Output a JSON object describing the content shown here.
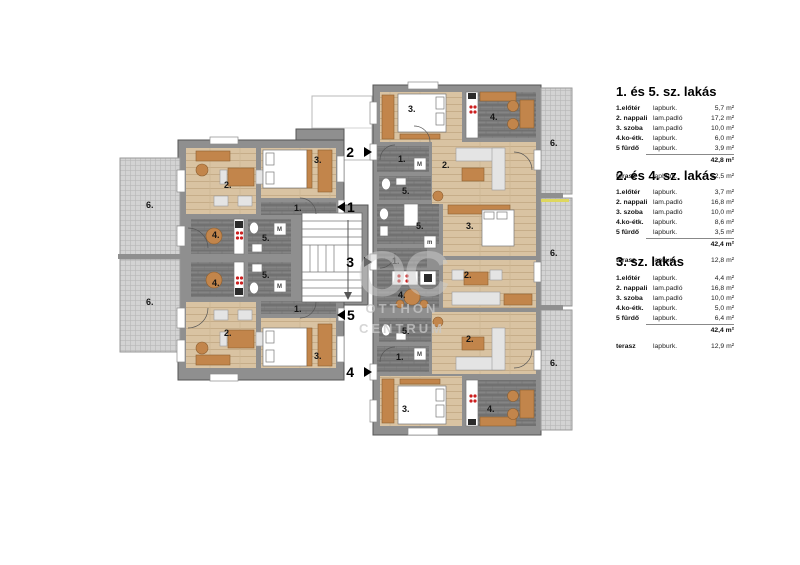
{
  "plan": {
    "room_labels": {
      "entry": "1.",
      "living": "2.",
      "bedroom": "3.",
      "kitchen": "4.",
      "bath": "5.",
      "terrace": "6."
    },
    "entries": [
      "1",
      "2",
      "3",
      "4",
      "5"
    ],
    "fixtures": {
      "washer": "M",
      "washer_small": "m"
    }
  },
  "watermark": {
    "logo": "OC",
    "line1": "OTTHON",
    "line2": "CENTRUM"
  },
  "legend": {
    "sections": [
      {
        "title": "1. és 5. sz. lakás",
        "rows": [
          {
            "name": "1.előtér",
            "finish": "lapburk.",
            "area": "5,7 m²"
          },
          {
            "name": "2. nappali",
            "finish": "lam.padló",
            "area": "17,2 m²"
          },
          {
            "name": "3. szoba",
            "finish": "lam.padló",
            "area": "10,0 m²"
          },
          {
            "name": "4.ko-étk.",
            "finish": "lapburk.",
            "area": "6,0 m²"
          },
          {
            "name": "5 fürdő",
            "finish": "lapburk.",
            "area": "3,9 m²"
          }
        ],
        "total": "42,8 m²",
        "terrace": {
          "name": "terasz",
          "finish": "lapburk.",
          "area": "12,5 m²"
        }
      },
      {
        "title": "2. és 4. sz. lakás",
        "rows": [
          {
            "name": "1.előtér",
            "finish": "lapburk.",
            "area": "3,7 m²"
          },
          {
            "name": "2. nappali",
            "finish": "lam.padló",
            "area": "16,8 m²"
          },
          {
            "name": "3. szoba",
            "finish": "lam.padló",
            "area": "10,0 m²"
          },
          {
            "name": "4.ko-étk.",
            "finish": "lapburk.",
            "area": "8,6 m²"
          },
          {
            "name": "5 fürdő",
            "finish": "lapburk.",
            "area": "3,5 m²"
          }
        ],
        "total": "42,4 m²",
        "terrace": {
          "name": "terasz",
          "finish": "lapburk.",
          "area": "12,8 m²"
        }
      },
      {
        "title": "3. sz. lakás",
        "rows": [
          {
            "name": "1.előtér",
            "finish": "lapburk.",
            "area": "4,4 m²"
          },
          {
            "name": "2. nappali",
            "finish": "lam.padló",
            "area": "16,8 m²"
          },
          {
            "name": "3. szoba",
            "finish": "lam.padló",
            "area": "10,0 m²"
          },
          {
            "name": "4.ko-étk.",
            "finish": "lapburk.",
            "area": "5,0 m²"
          },
          {
            "name": "5 fürdő",
            "finish": "lapburk.",
            "area": "6,4 m²"
          }
        ],
        "total": "42,4 m²",
        "terrace": {
          "name": "terasz",
          "finish": "lapburk.",
          "area": "12,9 m²"
        }
      }
    ]
  },
  "colors": {
    "wall": "#8f8f8f",
    "wood_floor": "#d9c3a2",
    "tile_floor": "#787878",
    "terrace": "#d4d4d4",
    "furniture_wood": "#c2854b",
    "stove_burner": "#cc1f1f",
    "terrace_accent": "#ded75f",
    "watermark": "#cdcdcd"
  }
}
